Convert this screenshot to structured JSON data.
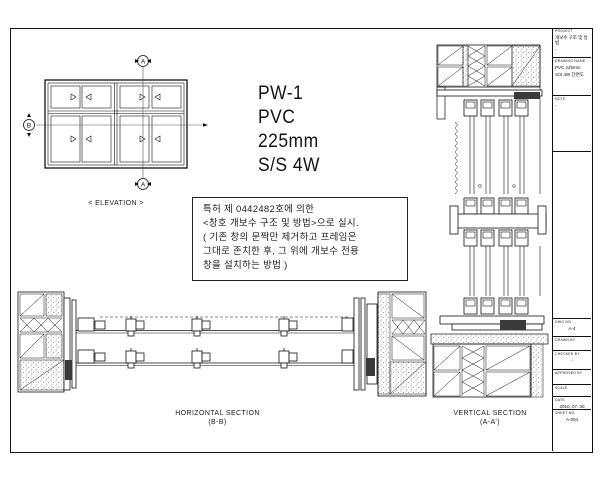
{
  "sheet": {
    "elevation": {
      "label": "< ELEVATION >",
      "marker_a_top": "A",
      "marker_a_bottom": "A",
      "marker_b": "B"
    },
    "spec": {
      "line1": "PW-1",
      "line2": "PVC",
      "line3": "225mm",
      "line4": "S/S 4W"
    },
    "note": {
      "line1": "특허 제 0442482호에 의한",
      "line2": "<창호 개보수 구조 및 방법>으로 실시.",
      "line3": "( 기존 창의 문짝만 제거하고 프레임은",
      "line4": "그대로 존치한 후, 그 위에 개보수 전용",
      "line5": "창을 설치하는 방법 )"
    },
    "horizontal_section": {
      "title": "HORIZONTAL SECTION",
      "subtitle": "(B-B)"
    },
    "vertical_section": {
      "title": "VERTICAL SECTION",
      "subtitle": "(A-A')"
    }
  },
  "title_block": {
    "project_label": "PROJECT",
    "project_value": "개보수 구조 및 방법",
    "project_sub": "-",
    "drawing_label": "DRAWING NAME",
    "drawing_value1": "PVC 225mm",
    "drawing_value2": "S/S 4W 단면도",
    "note_label": "NOTE",
    "note_value": "-",
    "rows": [
      {
        "label": "DWG No.",
        "value": "A-4"
      },
      {
        "label": "DRAWN BY",
        "value": ""
      },
      {
        "label": "CHECKED BY",
        "value": "-"
      },
      {
        "label": "APPROVED BY",
        "value": ""
      },
      {
        "label": "SCALE",
        "value": ""
      },
      {
        "label": "DATE",
        "value": "2010. 07. 30"
      },
      {
        "label": "SHEET No.",
        "value": "A-004"
      }
    ]
  },
  "colors": {
    "line": "#111111",
    "dark_fill": "#3a3a3a",
    "background": "#ffffff"
  }
}
